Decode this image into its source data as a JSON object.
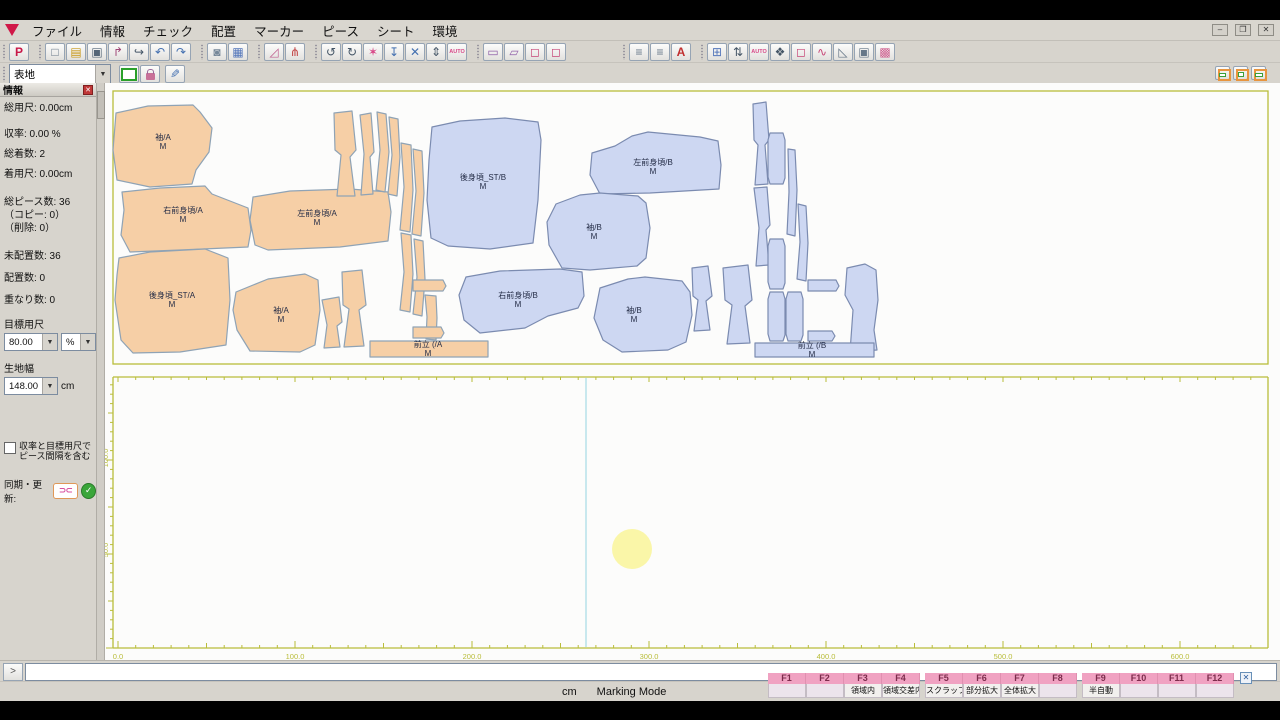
{
  "window": {
    "buttons": [
      {
        "name": "minimize",
        "glyph": "–"
      },
      {
        "name": "restore",
        "glyph": "❐"
      },
      {
        "name": "close",
        "glyph": "✕"
      }
    ]
  },
  "menu": {
    "items": [
      "ファイル",
      "情報",
      "チェック",
      "配置",
      "マーカー",
      "ピース",
      "シート",
      "環境"
    ]
  },
  "toolbar": {
    "row1": [
      [
        {
          "n": "plot",
          "g": "P",
          "c": "#c81848",
          "bold": true
        }
      ],
      [
        {
          "n": "new-file",
          "g": "□",
          "c": "#667788"
        },
        {
          "n": "open-file",
          "g": "▤",
          "c": "#c89818"
        },
        {
          "n": "save-file",
          "g": "▣",
          "c": "#556677"
        },
        {
          "n": "pick-piece",
          "g": "↱",
          "c": "#a04878"
        },
        {
          "n": "pan-tool",
          "g": "↪",
          "c": "#445566"
        },
        {
          "n": "undo",
          "g": "↶",
          "c": "#4470b0"
        },
        {
          "n": "redo",
          "g": "↷",
          "c": "#4470b0"
        }
      ],
      [
        {
          "n": "lock",
          "g": "◙",
          "c": "#778899"
        },
        {
          "n": "piece-table",
          "g": "▦",
          "c": "#5577bb"
        }
      ],
      [
        {
          "n": "measure-angle",
          "g": "◿",
          "c": "#c06090"
        },
        {
          "n": "tools-wrench",
          "g": "⋔",
          "c": "#c04040"
        }
      ],
      [
        {
          "n": "rotate-left",
          "g": "↺",
          "c": "#445566"
        },
        {
          "n": "rotate-right",
          "g": "↻",
          "c": "#445566"
        },
        {
          "n": "flash-check",
          "g": "✶",
          "c": "#d84888"
        },
        {
          "n": "drop-piece",
          "g": "↧",
          "c": "#4470b0"
        },
        {
          "n": "overlap-check",
          "g": "✕",
          "c": "#4470b0"
        },
        {
          "n": "fit-vertical",
          "g": "⇕",
          "c": "#445566"
        },
        {
          "n": "auto-nest",
          "g": "AUTO",
          "c": "#d84888",
          "auto": true
        }
      ],
      [
        {
          "n": "annotation",
          "g": "▭",
          "c": "#9060a8"
        },
        {
          "n": "annotation-flag",
          "g": "▱",
          "c": "#9060a8"
        },
        {
          "n": "piece-front",
          "g": "◻",
          "c": "#c84878"
        },
        {
          "n": "piece-back",
          "g": "◻",
          "c": "#c84878"
        }
      ],
      [
        {
          "n": "spec-list",
          "g": "≡",
          "c": "#667788"
        },
        {
          "n": "order-list",
          "g": "≡",
          "c": "#667788"
        },
        {
          "n": "label-a",
          "g": "A",
          "c": "#c03030",
          "bold": true
        }
      ],
      [
        {
          "n": "marker-grid",
          "g": "⊞",
          "c": "#5577bb"
        },
        {
          "n": "width-fit",
          "g": "⇅",
          "c": "#445566"
        },
        {
          "n": "auto-marking",
          "g": "AUTO",
          "c": "#d84888",
          "auto": true
        },
        {
          "n": "ink-stamp",
          "g": "❖",
          "c": "#445566"
        },
        {
          "n": "piece-outline",
          "g": "◻",
          "c": "#c84878"
        },
        {
          "n": "curve-tool",
          "g": "∿",
          "c": "#c84878"
        },
        {
          "n": "corner-tool",
          "g": "◺",
          "c": "#667788"
        },
        {
          "n": "save-window",
          "g": "▣",
          "c": "#667788"
        },
        {
          "n": "fabric-pattern",
          "g": "▩",
          "c": "#d06090"
        }
      ]
    ],
    "fabric_value": "表地"
  },
  "sidebar": {
    "title": "情報",
    "close_glyph": "✕",
    "stats": [
      "総用尺: 0.00cm",
      "収率: 0.00 %",
      "総着数: 2",
      "着用尺: 0.00cm",
      "総ピース数: 36",
      "（コピー: 0）",
      "（削除: 0）",
      "未配置数: 36",
      "配置数: 0",
      "重なり数: 0"
    ],
    "target_label": "目標用尺",
    "target_value": "80.00",
    "target_unit": "%",
    "width_label": "生地幅",
    "width_value": "148.00",
    "width_unit": "cm",
    "checkbox_label": "収率と目標用尺でピース間隔を含む",
    "sync_label": "同期・更新:",
    "sync_glyph": "⊃⊂",
    "check_glyph": "✓"
  },
  "command": {
    "prompt_glyph": ">",
    "input_value": ""
  },
  "status": {
    "unit": "cm",
    "mode": "Marking Mode"
  },
  "fkeys": [
    {
      "key": "F1",
      "label": ""
    },
    {
      "key": "F2",
      "label": ""
    },
    {
      "key": "F3",
      "label": "領域内"
    },
    {
      "key": "F4",
      "label": "領域交差内"
    },
    {
      "key": "F5",
      "label": "スクラップ移動"
    },
    {
      "key": "F6",
      "label": "部分拡大"
    },
    {
      "key": "F7",
      "label": "全体拡大"
    },
    {
      "key": "F8",
      "label": ""
    },
    {
      "key": "F9",
      "label": "半自動"
    },
    {
      "key": "F10",
      "label": ""
    },
    {
      "key": "F11",
      "label": ""
    },
    {
      "key": "F12",
      "label": ""
    }
  ],
  "colors": {
    "piece_a_fill": "#f6cfa6",
    "piece_a_stroke": "#8fa3b5",
    "piece_b_fill": "#cdd7f2",
    "piece_b_stroke": "#7b8bb0",
    "ruler": "#b9bd3a",
    "guide": "#a5dae6",
    "highlight": "#faf59e",
    "label_text": "#242c46"
  },
  "marker_area": {
    "guide_x": 586,
    "highlight": {
      "x": 632,
      "y": 549,
      "r": 20
    },
    "h_ruler_labels": [
      {
        "text": "0.0",
        "x": 118
      },
      {
        "text": "100.0",
        "x": 295
      },
      {
        "text": "200.0",
        "x": 472
      },
      {
        "text": "300.0",
        "x": 649
      },
      {
        "text": "400.0",
        "x": 826
      },
      {
        "text": "500.0",
        "x": 1003
      },
      {
        "text": "600.0",
        "x": 1180
      }
    ],
    "v_ruler_labels": [
      {
        "text": "100.0",
        "y": 458
      },
      {
        "text": "50.0",
        "y": 550
      }
    ]
  },
  "pieces": [
    {
      "name": "sleeve-A-1",
      "t": "A",
      "pts": "116,113 148,106 193,105 200,112 212,128 209,152 196,170 192,184 150,187 117,180 113,150",
      "label": "袖/A",
      "lx": 163,
      "ly": 140
    },
    {
      "name": "right-front-A",
      "t": "A",
      "pts": "122,192 160,188 205,186 212,194 248,208 251,230 248,247 180,250 130,252 121,235 124,210",
      "label": "右前身頃/A",
      "lx": 183,
      "ly": 213
    },
    {
      "name": "left-front-A",
      "t": "A",
      "pts": "253,197 290,191 350,189 388,192 391,212 388,241 340,247 268,250 255,245 250,220",
      "label": "左前身頃/A",
      "lx": 317,
      "ly": 216
    },
    {
      "name": "back-A",
      "t": "A",
      "pts": "119,258 150,252 205,249 228,258 230,300 226,345 180,352 133,353 121,340 115,300 117,275",
      "label": "後身頃_ST/A",
      "lx": 172,
      "ly": 298
    },
    {
      "name": "sleeve-A-2",
      "t": "A",
      "pts": "236,292 268,279 305,274 318,280 320,310 315,345 300,352 250,351 237,330 233,310",
      "label": "袖/A",
      "lx": 281,
      "ly": 313
    },
    {
      "name": "placket-A",
      "t": "A",
      "pts": "370,341 488,341 488,357 370,357",
      "label": "前立 (/A",
      "lx": 428,
      "ly": 347
    },
    {
      "name": "strip-A1",
      "t": "A",
      "pts": "334,113 352,111 356,150 350,157 355,196 337,196 341,155 335,150"
    },
    {
      "name": "strip-A2",
      "t": "A",
      "pts": "360,115 371,113 374,152 370,157 373,194 361,195 364,154"
    },
    {
      "name": "strip-A3",
      "t": "A",
      "pts": "377,112 386,114 389,152 385,192 376,190 380,150"
    },
    {
      "name": "strip-A4",
      "t": "A",
      "pts": "389,117 398,119 400,157 397,196 388,194 392,155"
    },
    {
      "name": "strip-A5",
      "t": "A",
      "pts": "401,143 411,145 413,190 410,232 400,230 404,187"
    },
    {
      "name": "strip-A6",
      "t": "A",
      "pts": "413,149 422,151 424,193 421,236 412,234 416,191"
    },
    {
      "name": "strip-A7",
      "t": "A",
      "pts": "401,233 411,235 413,274 410,312 400,310 404,272"
    },
    {
      "name": "strip-A8",
      "t": "A",
      "pts": "414,239 423,241 425,279 422,316 413,314 417,277"
    },
    {
      "name": "cuff-A1",
      "t": "A",
      "pts": "342,272 362,270 366,305 359,310 364,346 344,347 349,309 343,305"
    },
    {
      "name": "cuff-A2",
      "t": "A",
      "pts": "322,300 339,297 342,322 337,326 340,347 324,348 327,325"
    },
    {
      "name": "tag-A1",
      "t": "A",
      "pts": "413,280 443,280 446,286 443,291 413,291"
    },
    {
      "name": "strip-A9",
      "t": "A",
      "pts": "425,295 436,296 437,318 436,340 426,339 427,317"
    },
    {
      "name": "tag-A2",
      "t": "A",
      "pts": "413,327 441,327 444,333 441,338 413,338"
    },
    {
      "name": "back-B",
      "t": "B",
      "pts": "432,127 460,121 505,118 538,122 541,140 538,200 533,243 490,249 448,246 431,238 427,200 429,160",
      "label": "後身頃_ST/B",
      "lx": 483,
      "ly": 180
    },
    {
      "name": "left-front-B",
      "t": "B",
      "pts": "592,153 615,146 632,136 648,132 700,137 718,141 721,165 719,189 650,193 600,194 590,175",
      "label": "左前身頃/B",
      "lx": 653,
      "ly": 165
    },
    {
      "name": "sleeve-B-1",
      "t": "B",
      "pts": "556,204 580,195 600,193 638,196 646,203 650,228 646,258 637,266 590,270 562,268 549,245 547,222",
      "label": "袖/B",
      "lx": 594,
      "ly": 230
    },
    {
      "name": "right-front-B",
      "t": "B",
      "pts": "466,277 500,271 560,269 582,272 584,296 578,308 548,316 525,328 480,333 464,320 459,295",
      "label": "右前身頃/B",
      "lx": 518,
      "ly": 298
    },
    {
      "name": "sleeve-B-2",
      "t": "B",
      "pts": "600,288 628,279 645,277 682,281 690,292 692,315 686,342 668,350 622,352 603,340 594,318",
      "label": "袖/B",
      "lx": 634,
      "ly": 313
    },
    {
      "name": "cuff-B1",
      "t": "B",
      "pts": "692,268 708,266 712,296 706,301 710,330 694,331 698,300 693,296"
    },
    {
      "name": "cuff-B2",
      "t": "B",
      "pts": "723,268 748,265 752,300 745,306 750,343 727,344 732,305 725,300"
    },
    {
      "name": "strip-B1",
      "t": "B",
      "pts": "753,104 766,102 769,140 765,145 768,184 755,185 758,145 754,140"
    },
    {
      "name": "strip-B2",
      "t": "B",
      "pts": "754,188 767,187 770,225 766,230 769,265 756,266 759,228"
    },
    {
      "name": "band-B1",
      "t": "B",
      "pts": "770,133 783,133 785,140 785,178 783,184 770,184 768,177 768,140"
    },
    {
      "name": "strip-B3",
      "t": "B",
      "pts": "788,149 795,150 797,190 795,236 787,234 789,192"
    },
    {
      "name": "strip-B4",
      "t": "B",
      "pts": "798,204 806,206 808,243 806,281 797,279 800,242"
    },
    {
      "name": "band-B2",
      "t": "B",
      "pts": "770,239 783,239 785,246 785,283 783,289 770,289 768,282 768,246"
    },
    {
      "name": "band-B3",
      "t": "B",
      "pts": "770,292 783,292 785,299 785,335 783,341 770,341 768,334 768,299"
    },
    {
      "name": "band-B4",
      "t": "B",
      "pts": "788,292 801,292 803,299 803,335 801,341 788,341 786,334 786,299"
    },
    {
      "name": "tag-B1",
      "t": "B",
      "pts": "808,280 836,280 839,286 836,291 808,291"
    },
    {
      "name": "tag-B2",
      "t": "B",
      "pts": "808,331 832,331 835,336 832,341 808,341"
    },
    {
      "name": "collar-B",
      "t": "B",
      "pts": "847,268 865,264 876,270 878,300 874,330 877,350 850,352 853,310 845,295"
    },
    {
      "name": "placket-B",
      "t": "B",
      "pts": "755,343 874,343 874,357 755,357",
      "label": "前立 (/B",
      "lx": 812,
      "ly": 348
    }
  ]
}
